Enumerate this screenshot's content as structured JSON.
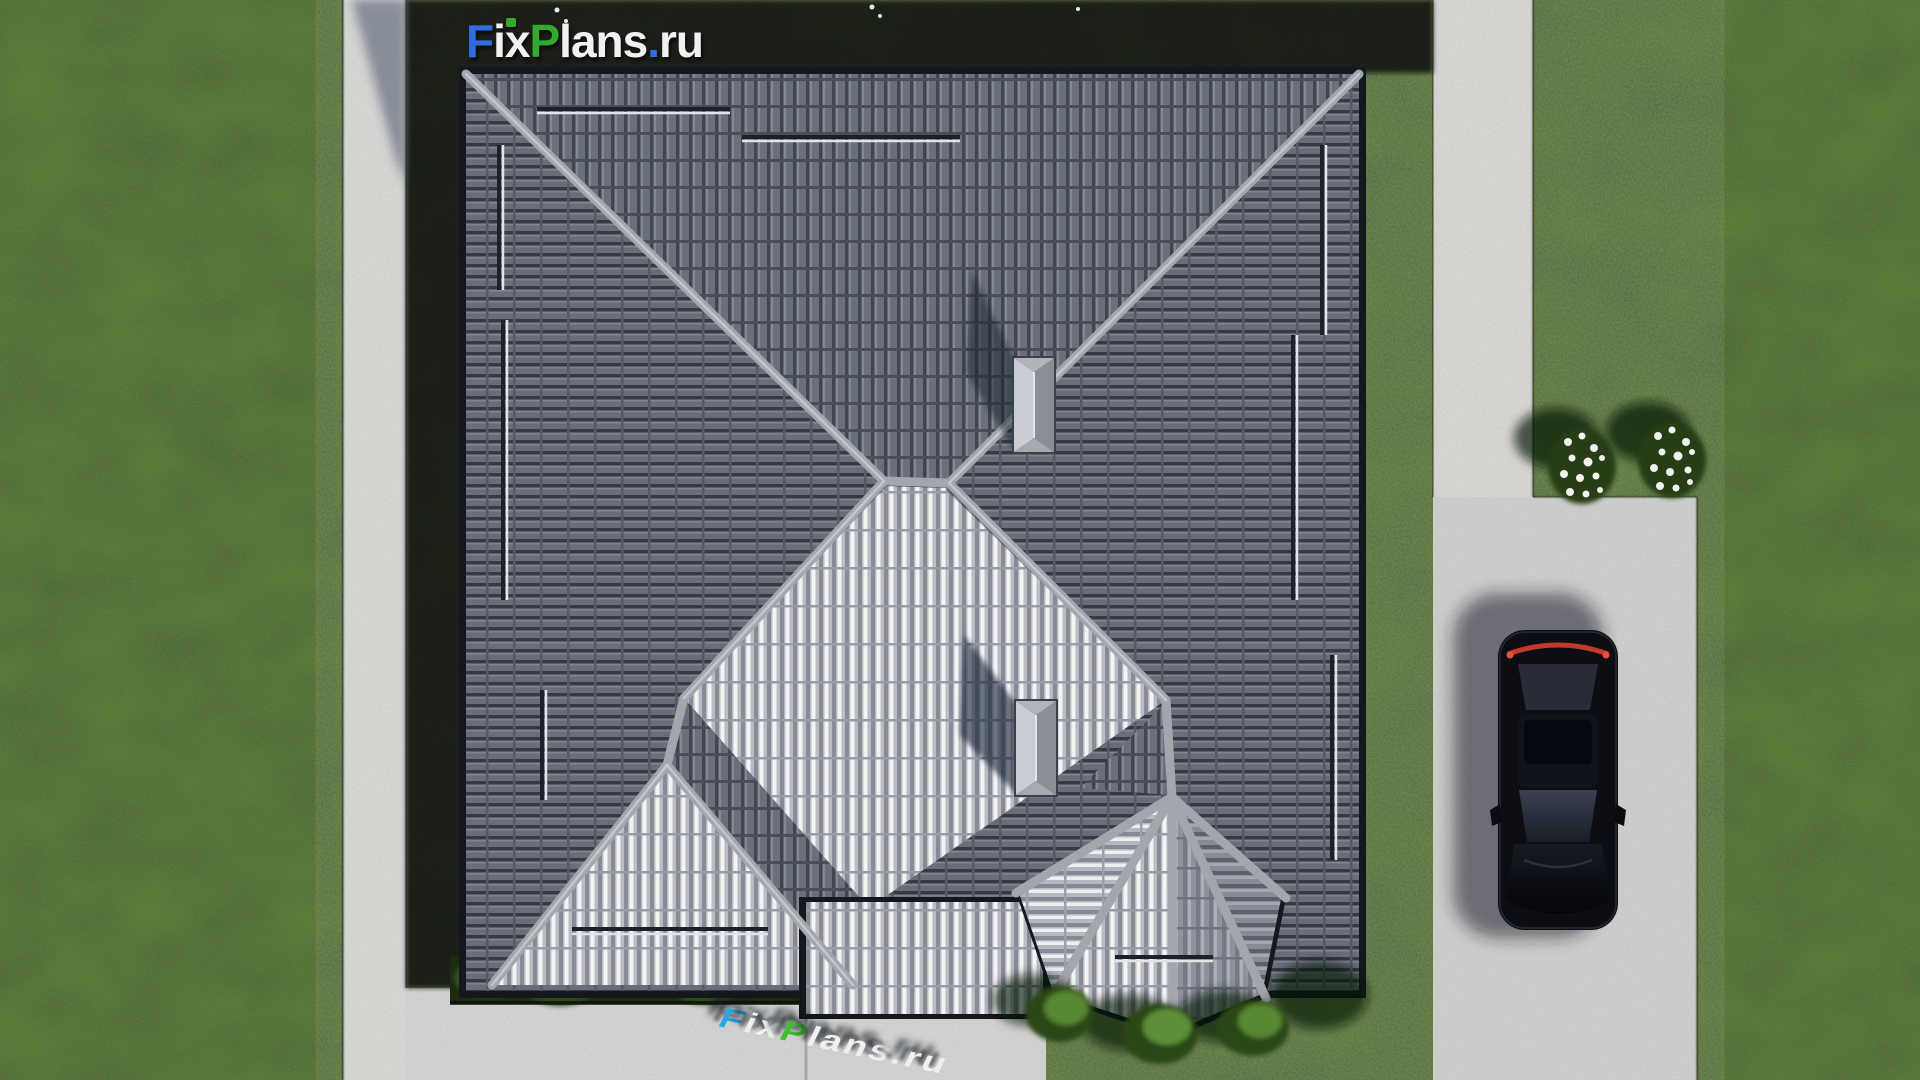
{
  "branding": {
    "logo_top": {
      "f": "F",
      "ix": "ix",
      "p": "P",
      "lans": "lans",
      "dot": ".",
      "ru": "ru",
      "full": "FixPlans.ru"
    },
    "logo_bottom": {
      "f": "F",
      "ix": "ix",
      "p": "P",
      "lans": "lans",
      "dot": ".",
      "ru": "ru",
      "full": "FixPlans.ru"
    }
  },
  "colors": {
    "logo_blue": "#2e6fe0",
    "logo_green": "#35a82f",
    "logo_white": "#f1f1f3",
    "watermark_blue": "#2aa7e8",
    "watermark_green": "#3fbf2e",
    "grass": "#4a6627",
    "house_shadow": "#10150c",
    "concrete": "#d6d7d5",
    "roof_dark_tile": "#6a6f7b",
    "roof_bright_tile": "#d9dbe0",
    "ridge_cap": "#a2a6ad",
    "car_body": "#0c0e14",
    "car_taillight": "#cf4030",
    "flower_white": "#f2f2ee"
  },
  "scene": {
    "objects": [
      "lawn",
      "walkway-left",
      "walkway-right",
      "driveway",
      "patio",
      "hip-roof",
      "bay-roof",
      "chimney-1",
      "chimney-2",
      "snow-guards",
      "hedge",
      "bushes",
      "flower-beds",
      "parked-car",
      "logo-watermark-top",
      "logo-watermark-ground"
    ]
  }
}
